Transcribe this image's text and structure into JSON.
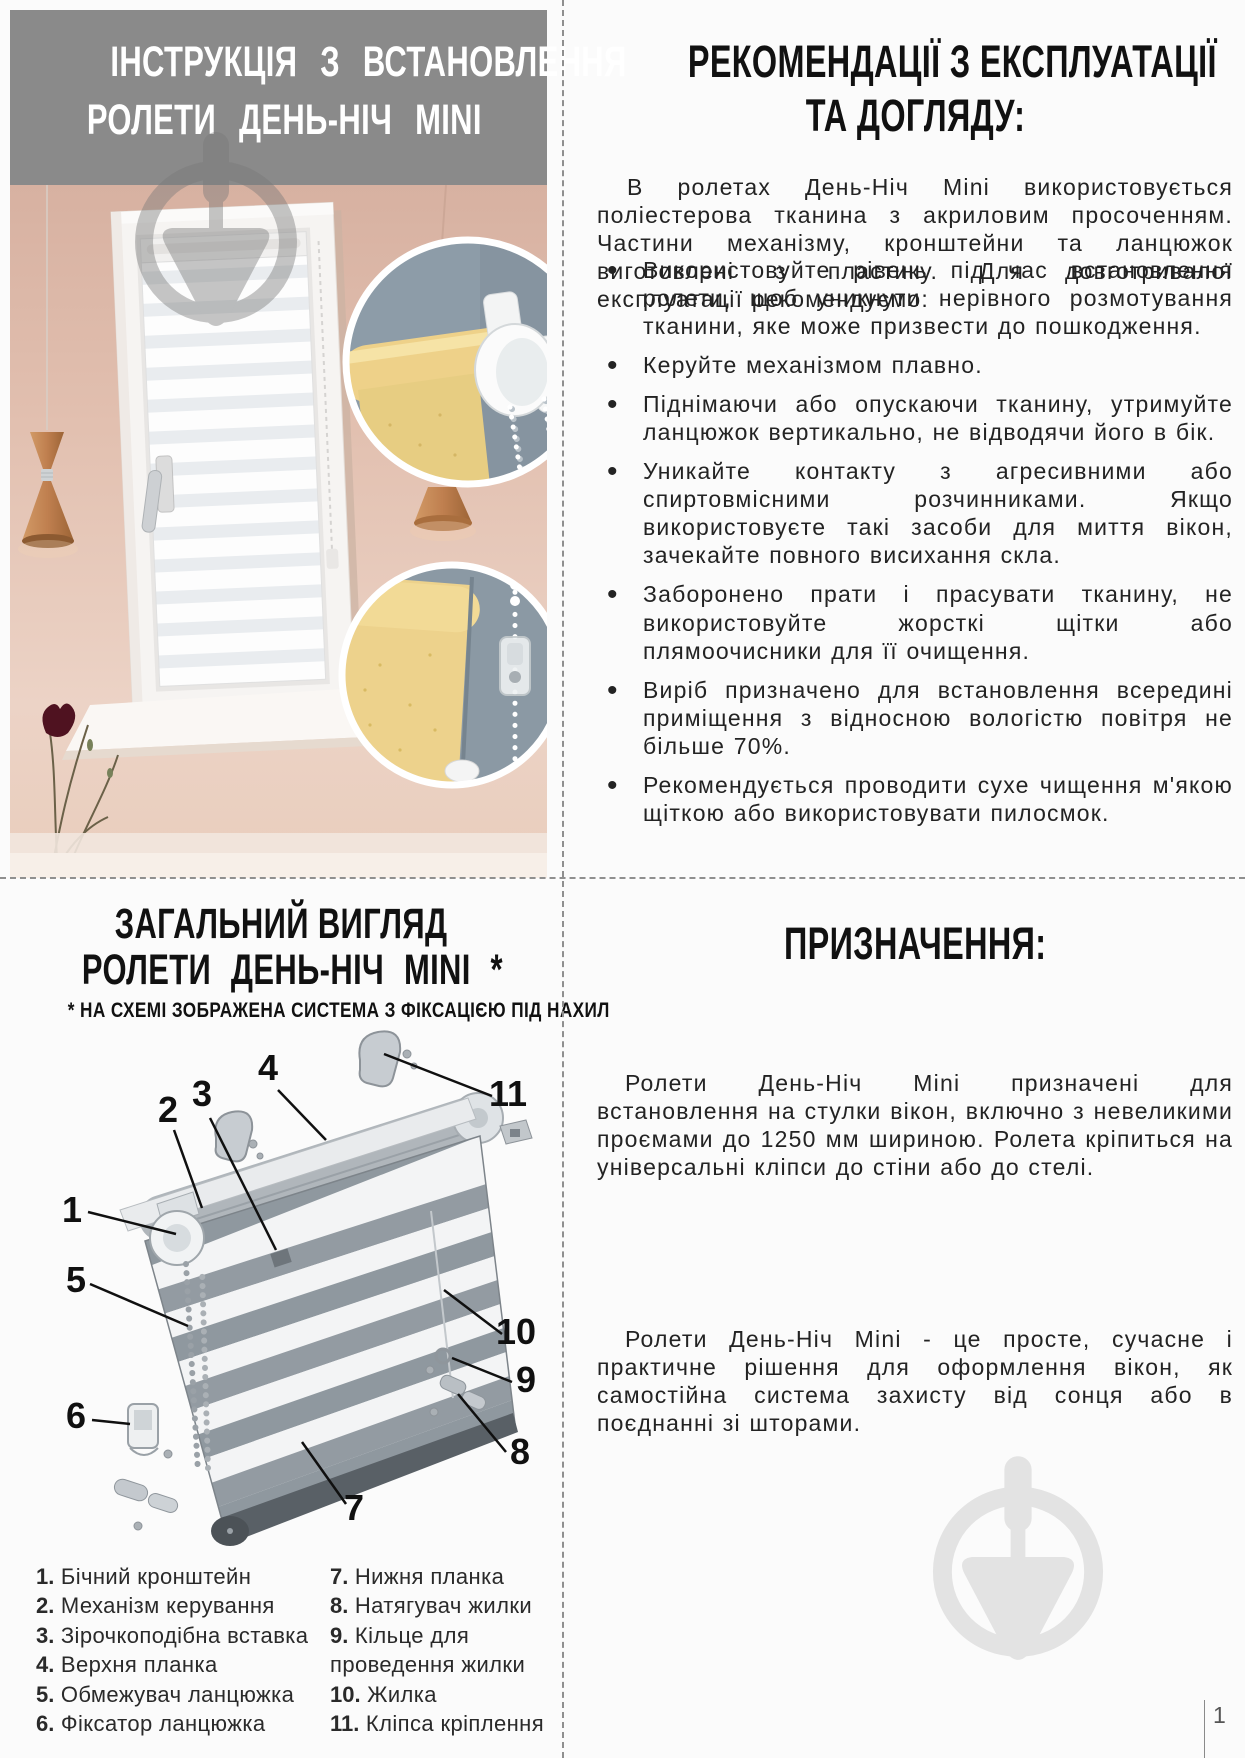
{
  "install_header": {
    "line1": "ІНСТРУКЦІЯ З ВСТАНОВЛЕННЯ",
    "line2": "РОЛЕТИ ДЕНЬ-НІЧ MINI"
  },
  "recommendations": {
    "title_line1": "РЕКОМЕНДАЦІЇ З ЕКСПЛУАТАЦІЇ",
    "title_line2": "ТА ДОГЛЯДУ:",
    "intro": "В ролетах День-Ніч Mini використовується поліестерова тканина з акриловим просоченням. Частини механізму, кронштейни та ланцюжок виготовлені з пластику. Для довготривалої експлуатації рекомендуємо:",
    "bullets": [
      "Використовуйте рівень під час встановлення ролети, щоб уникнути нерівного розмотування тканини, яке може призвести до пошкодження.",
      "Керуйте механізмом плавно.",
      "Піднімаючи або опускаючи тканину, утримуйте ланцюжок вертикально, не відводячи його в бік.",
      "Уникайте контакту з агресивними або спиртовмісними розчинниками. Якщо використовуєте такі засоби для миття вікон, зачекайте повного висихання скла.",
      "Заборонено прати і прасувати тканину, не використовуйте жорсткі щітки або плямоочисники для її очищення.",
      "Виріб призначено для встановлення всередині приміщення з відносною вологістю повітря не більше 70%.",
      "Рекомендується проводити сухе чищення м'якою щіткою або використовувати пилосмок."
    ]
  },
  "overview": {
    "title_line1": "ЗАГАЛЬНИЙ ВИГЛЯД",
    "title_line2": "РОЛЕТИ ДЕНЬ-НІЧ MINI *",
    "note": "* НА СХЕМІ ЗОБРАЖЕНА СИСТЕМА З ФІКСАЦІЄЮ ПІД НАХИЛ",
    "legend": [
      {
        "num": "1.",
        "label": "Бічний кронштейн"
      },
      {
        "num": "2.",
        "label": "Механізм керування"
      },
      {
        "num": "3.",
        "label": "Зірочкоподібна вставка"
      },
      {
        "num": "4.",
        "label": "Верхня планка"
      },
      {
        "num": "5.",
        "label": "Обмежувач ланцюжка"
      },
      {
        "num": "6.",
        "label": "Фіксатор ланцюжка"
      },
      {
        "num": "7.",
        "label": "Нижня планка"
      },
      {
        "num": "8.",
        "label": "Натягувач жилки"
      },
      {
        "num": "9.",
        "label": "Кільце для проведення жилки"
      },
      {
        "num": "10.",
        "label": "Жилка"
      },
      {
        "num": "11.",
        "label": "Кліпса кріплення"
      }
    ],
    "callouts": [
      {
        "n": "1"
      },
      {
        "n": "2"
      },
      {
        "n": "3"
      },
      {
        "n": "4"
      },
      {
        "n": "5"
      },
      {
        "n": "6"
      },
      {
        "n": "7"
      },
      {
        "n": "8"
      },
      {
        "n": "9"
      },
      {
        "n": "10"
      },
      {
        "n": "11"
      }
    ]
  },
  "purpose": {
    "title": "ПРИЗНАЧЕННЯ:",
    "p1": "Ролети День-Ніч Mini призначені для встановлення на стулки вікон, включно з невеликими проємами до 1250 мм шириною. Ролета кріпиться на універсальні кліпси до стіни або до стелі.",
    "p2": "Ролети День-Ніч Mini - це просте, сучасне і практичне рішення для оформлення вікон, як самостійна система захисту від сонця або в поєднанні зі шторами."
  },
  "page": {
    "number": "1"
  },
  "colors": {
    "banner_gray": "#8a8a8a",
    "wall_pink": "#ddb7a7",
    "inset_slate": "#8d9ca8",
    "fabric_yellow": "#eed189",
    "copper": "#bf7f4f",
    "watermark_gray": "#e3e3e3"
  }
}
